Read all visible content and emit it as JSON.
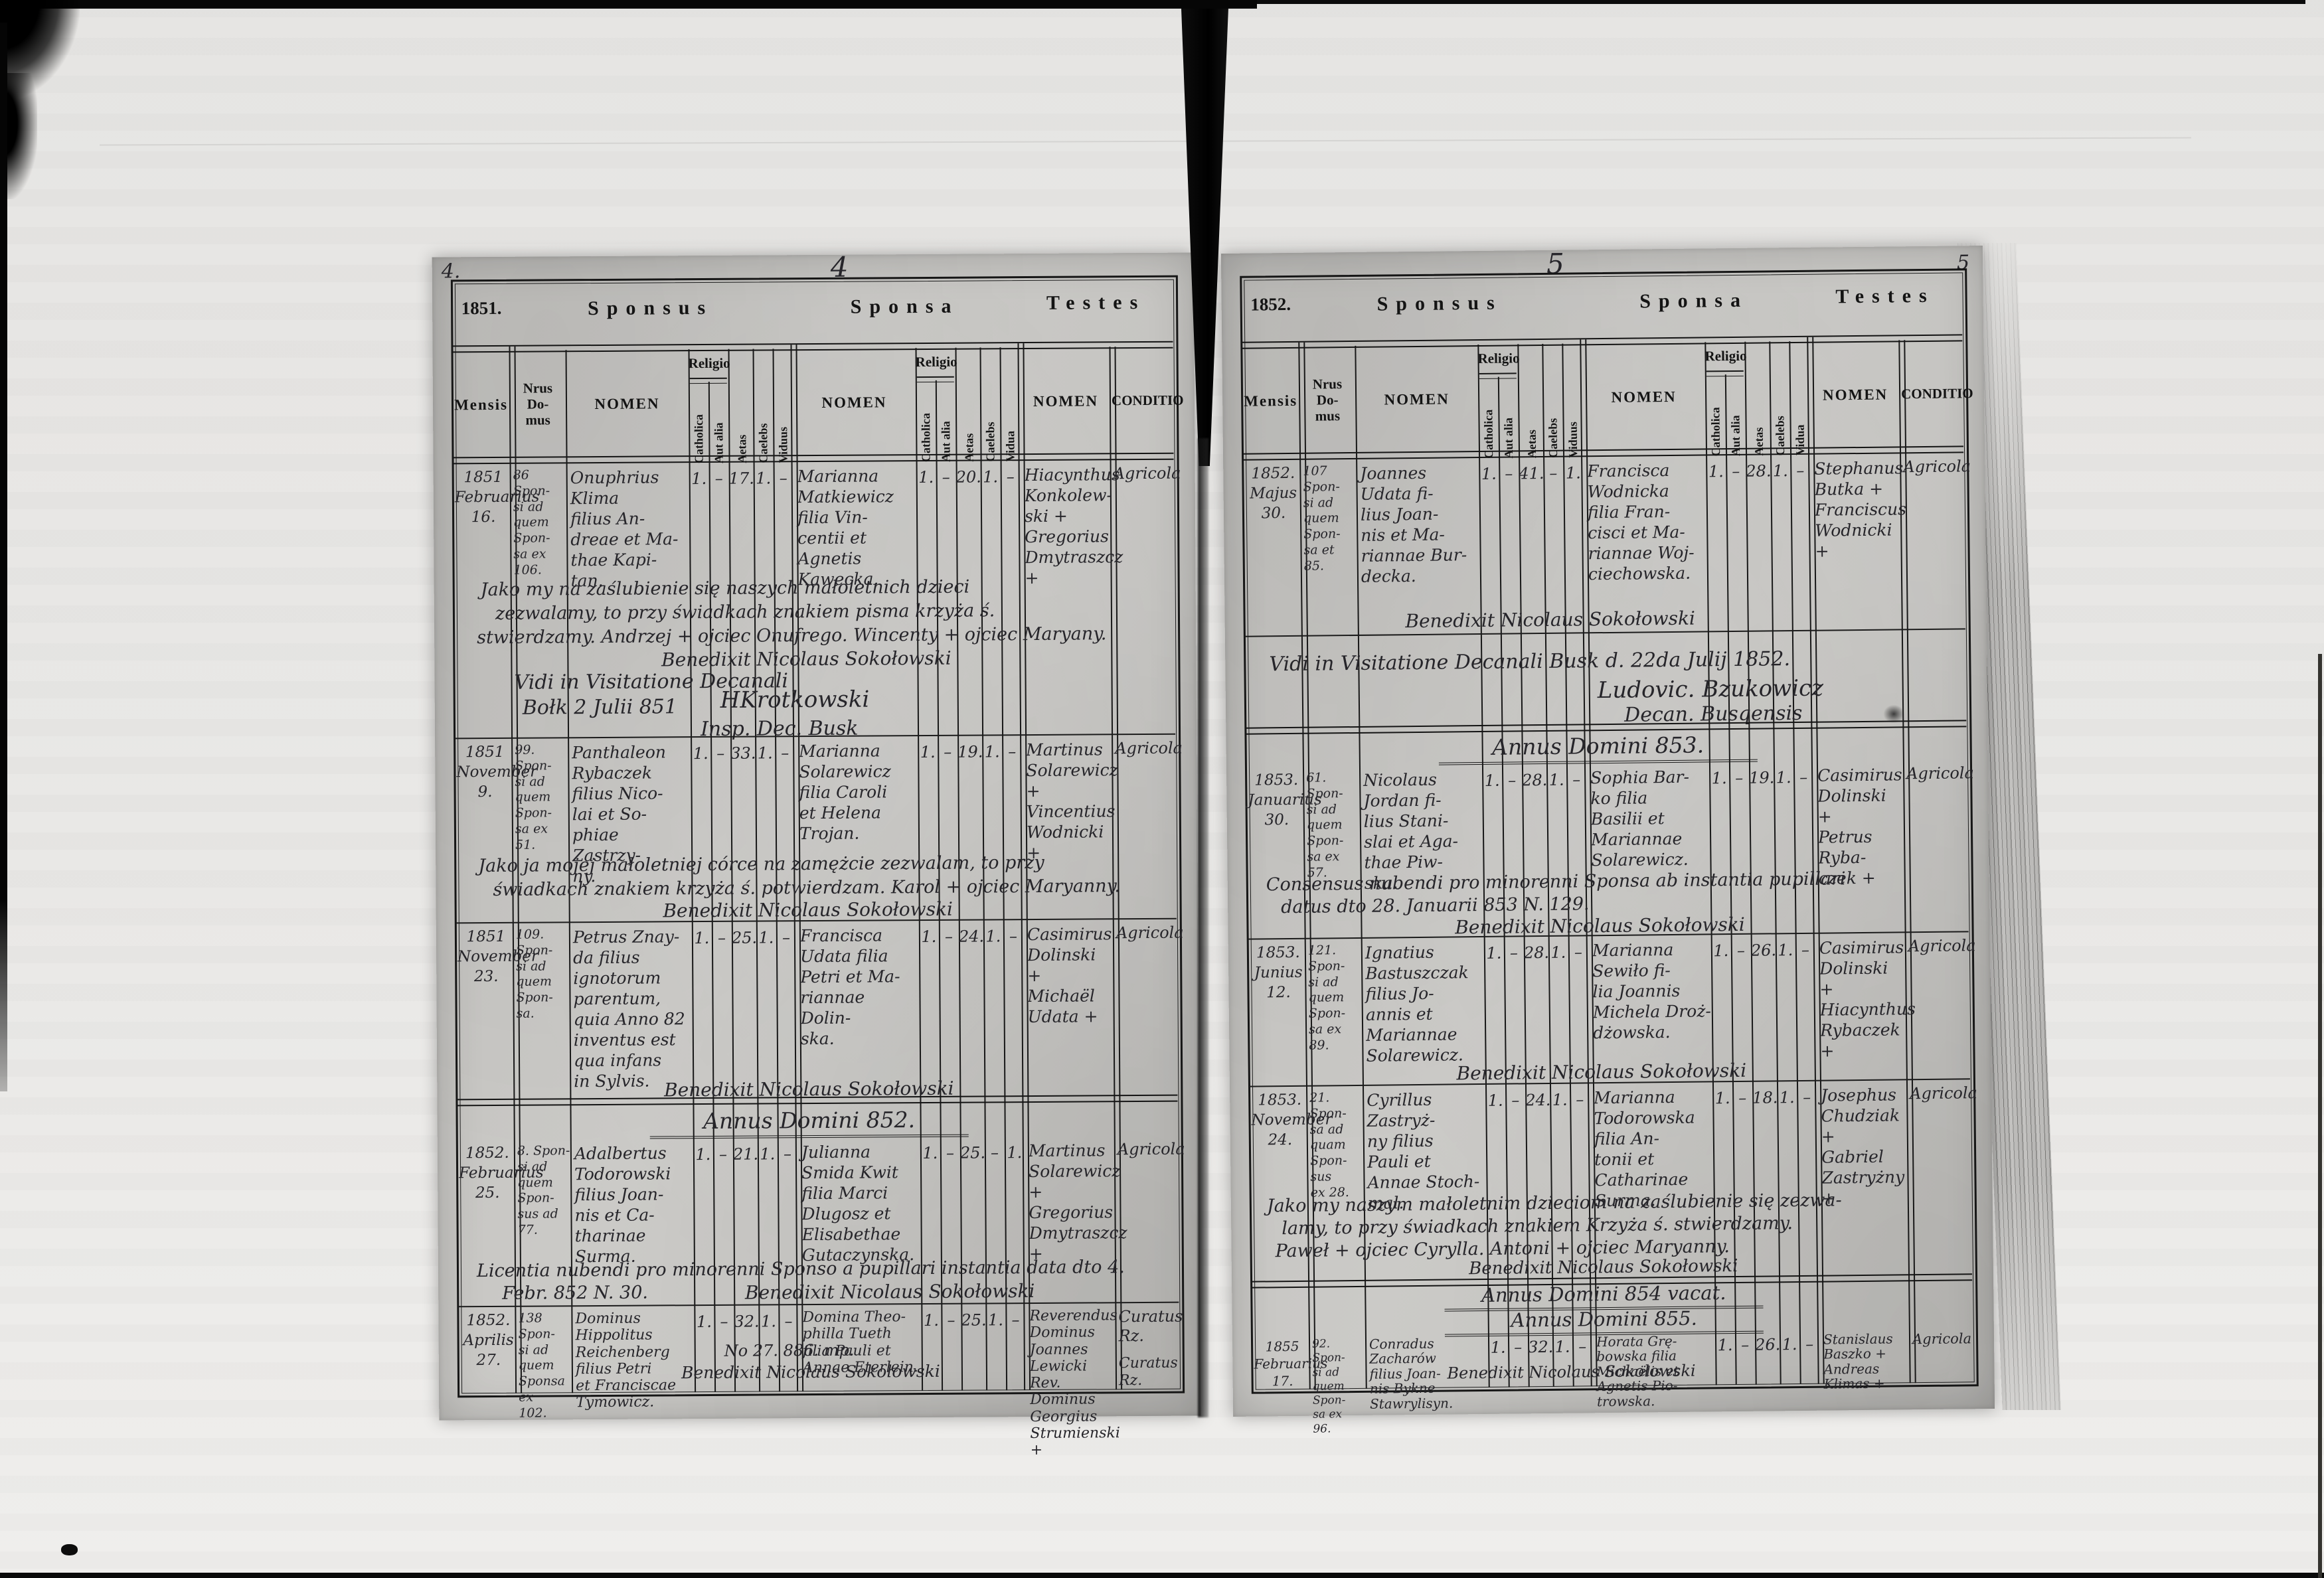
{
  "labels": {
    "sponsus": "Sponsus",
    "sponsa": "Sponsa",
    "testes": "Testes",
    "mensis": "Mensis",
    "nrus_domus": "Nrus\nDo-\nmus",
    "nomen": "NOMEN",
    "religio": "Religio",
    "catholica": "Catholica",
    "aut_alia": "Aut alia",
    "aetas": "Aetas",
    "caelebs": "Caelebs",
    "viduus": "Viduus",
    "vidua": "Vidua",
    "conditio": "CONDITIO"
  },
  "p4": {
    "corner": "4.",
    "number": "4",
    "year": "1851.",
    "heading_852": "Annus Domini 852.",
    "visitation": {
      "l1": "Vidi in Visitatione Decanali",
      "l2": "Bołk 2 Julii 851",
      "sig": "HKrotkowski",
      "l3": "Insp. Dec. Busk"
    },
    "e": [
      {
        "date": "1851\nFebruarius\n16.",
        "house": "86 Spon-\nsi ad\nquem\nSpon-\nsa ex\n106.",
        "sponsus": "Onuphrius\nKlima\nfilius An-\ndreae et Ma-\nthae Kapi-\ntan.",
        "sv": [
          "1.",
          "–",
          "17.",
          "1.",
          "–"
        ],
        "sponsa": "Marianna\nMatkiewicz\nfilia Vin-\ncentii et\nAgnetis\nKawecka.",
        "pv": [
          "1.",
          "–",
          "20.",
          "1.",
          "–"
        ],
        "testes": "Hiacynthus\nKonkolew-\nski +\nGregorius\nDmytraszcz +",
        "conditio": "Agricola",
        "note1": "Jako my na zaślubienie się naszych małoletnich dzieci",
        "note2": "zezwalamy, to przy świadkach znakiem pisma krzyża ś.",
        "note3": "stwierdzamy. Andrzej + ojciec Onufrego. Wincenty + ojciec Maryany.",
        "benedixit": "Benedixit Nicolaus Sokołowski"
      },
      {
        "date": "1851\nNovember\n9.",
        "house": "99. Spon-\nsi ad\nquem\nSpon-\nsa ex\n51.",
        "sponsus": "Panthaleon\nRybaczek\nfilius Nico-\nlai et So-\nphiae Zastrzy-\nny.",
        "sv": [
          "1.",
          "–",
          "33.",
          "1.",
          "–"
        ],
        "sponsa": "Marianna\nSolarewicz\nfilia Caroli\net Helena\nTrojan.",
        "pv": [
          "1.",
          "–",
          "19.",
          "1.",
          "–"
        ],
        "testes": "Martinus\nSolarewicz +\nVincentius\nWodnicki +",
        "conditio": "Agricola",
        "note1": "Jako ja mojej małoletniej córce na zamężcie zezwalam, to przy",
        "note2": "świadkach znakiem krzyża ś. potwierdzam. Karol + ojciec Maryanny.",
        "benedixit": "Benedixit Nicolaus Sokołowski"
      },
      {
        "date": "1851\nNovember\n23.",
        "house": "109.\nSpon-\nsi ad\nquem\nSpon-\nsa.",
        "sponsus": "Petrus Znay-\nda filius\nignotorum\nparentum,\nquia Anno 82\ninventus est\nqua infans\nin Sylvis.",
        "sv": [
          "1.",
          "–",
          "25.",
          "1.",
          "–"
        ],
        "sponsa": "Francisca\nUdata filia\nPetri et Ma-\nriannae Dolin-\nska.",
        "pv": [
          "1.",
          "–",
          "24.",
          "1.",
          "–"
        ],
        "testes": "Casimirus\nDolinski +\nMichaël\nUdata +",
        "conditio": "Agricola",
        "benedixit": "Benedixit Nicolaus Sokołowski"
      },
      {
        "date": "1852.\nFebruarius\n25.",
        "house": "8. Spon-\nsi ad\nquem\nSpon-\nsus ad\n77.",
        "sponsus": "Adalbertus\nTodorowski\nfilius Joan-\nnis et Ca-\ntharinae\nSurma.",
        "sv": [
          "1.",
          "–",
          "21.",
          "1.",
          "–"
        ],
        "sponsa": "Julianna\nSmida Kwit\nfilia Marci\nDlugosz et\nElisabethae\nGutaczynska.",
        "pv": [
          "1.",
          "–",
          "25.",
          "–",
          "1."
        ],
        "testes": "Martinus\nSolarewicz +\nGregorius\nDmytraszcz +",
        "conditio": "Agricola",
        "note1": "Licentia nubendi pro minorenni Sponso a pupillari instantia data dto 4.",
        "note2": "Febr. 852 N. 30.",
        "benedixit": "Benedixit Nicolaus Sokołowski"
      },
      {
        "date": "1852.\nAprilis\n27.",
        "house": "138 Spon-\nsi ad\nquem\nSponsa\nex\n102.",
        "sponsus": "Dominus\nHippolitus\nReichenberg\nfilius Petri\net Franciscae\nTymowicz.",
        "sv": [
          "1.",
          "–",
          "32.",
          "1.",
          "–"
        ],
        "sponsa": "Domina Theo-\nphilla Tueth\nfilia Pauli et\nAnnae Eterlein.",
        "pv": [
          "1.",
          "–",
          "25.",
          "1.",
          "–"
        ],
        "note_mid": "No 27. 886. mp.",
        "testes": "Reverendus\nDominus\nJoannes\nLewicki\nRev. Dominus\nGeorgius\nStrumienski +",
        "conditio": "Curatus Rz.",
        "conditio2": "Curatus\nRz.",
        "benedixit": "Benedixit Nicolaus Sokołowski"
      }
    ]
  },
  "p5": {
    "corner": "5",
    "number": "5",
    "year": "1852.",
    "heading_853": "Annus Domini 853.",
    "heading_854": "Annus Domini 854 vacat.",
    "heading_855": "Annus Domini 855.",
    "visitation": {
      "l1": "Vidi in Visitatione Decanali Busk d. 22da Julij 1852.",
      "l2": "Ludovic. Bzukowicz",
      "l3": "Decan. Busqensis"
    },
    "e": [
      {
        "date": "1852.\nMajus\n30.",
        "house": "107 Spon-\nsi ad\nquem\nSpon-\nsa et\n85.",
        "sponsus": "Joannes\nUdata fi-\nlius Joan-\nnis et Ma-\nriannae Bur-\ndecka.",
        "sv": [
          "1.",
          "–",
          "41.",
          "–",
          "1."
        ],
        "sponsa": "Francisca\nWodnicka\nfilia Fran-\ncisci et Ma-\nriannae Woj-\nciechowska.",
        "pv": [
          "1.",
          "–",
          "28.",
          "1.",
          "–"
        ],
        "testes": "Stephanus\nButka +\nFranciscus\nWodnicki +",
        "conditio": "Agricola",
        "benedixit": "Benedixit Nicolaus Sokołowski"
      },
      {
        "date": "1853.\nJanuarius\n30.",
        "house": "61. Spon-\nsi ad\nquem\nSpon-\nsa ex\n57.",
        "sponsus": "Nicolaus\nJordan fi-\nlius Stani-\nslai et Aga-\nthae Piw-\nska.",
        "sv": [
          "1.",
          "–",
          "28.",
          "1.",
          "–"
        ],
        "sponsa": "Sophia Bar-\nko filia\nBasilii et\nMariannae\nSolarewicz.",
        "pv": [
          "1.",
          "–",
          "19.",
          "1.",
          "–"
        ],
        "testes": "Casimirus\nDolinski +\nPetrus Ryba-\nczek +",
        "conditio": "Agricola",
        "note1": "Consensus nubendi pro minorenni Sponsa ab instantia pupillari",
        "note2": "datus dto 28. Januarii 853 N. 129.",
        "benedixit": "Benedixit Nicolaus Sokołowski"
      },
      {
        "date": "1853.\nJunius\n12.",
        "house": "121. Spon-\nsi ad\nquem\nSpon-\nsa ex\n89.",
        "sponsus": "Ignatius\nBastuszczak\nfilius Jo-\nannis et\nMariannae\nSolarewicz.",
        "sv": [
          "1.",
          "–",
          "28.",
          "1.",
          "–"
        ],
        "sponsa": "Marianna\nSewiło fi-\nlia Joannis\nMichela Droż-\ndżowska.",
        "pv": [
          "1.",
          "–",
          "26.",
          "1.",
          "–"
        ],
        "testes": "Casimirus\nDolinski +\nHiacynthus\nRybaczek +",
        "conditio": "Agricola",
        "benedixit": "Benedixit Nicolaus Sokołowski"
      },
      {
        "date": "1853.\nNovember\n24.",
        "house": "21. Spon-\nsa ad\nquam\nSpon-\nsus\nex 28.",
        "sponsus": "Cyrillus\nZastryż-\nny filius\nPauli et\nAnnae Stoch-\nmal.",
        "sv": [
          "1.",
          "–",
          "24.",
          "1.",
          "–"
        ],
        "sponsa": "Marianna\nTodorowska\nfilia An-\ntonii et\nCatharinae\nSurma.",
        "pv": [
          "1.",
          "–",
          "18.",
          "1.",
          "–"
        ],
        "testes": "Josephus\nChudziak +\nGabriel\nZastryżny +",
        "conditio": "Agricola",
        "note1": "Jako my naszym małoletnim dzieciom na zaślubienie się zezwa-",
        "note2": "lamy, to przy świadkach znakiem Krzyża ś. stwierdzamy.",
        "note3": "Paweł + ojciec Cyrylla. Antoni + ojciec Maryanny.",
        "benedixit": "Benedixit Nicolaus Sokołowski"
      },
      {
        "date": "1855\nFebruarius\n17.",
        "house": "92. Spon-\nsi ad\nquem\nSpon-\nsa ex\n96.",
        "sponsus": "Conradus\nZacharów\nfilius Joan-\nnis Bykne\nStawrylisyn.",
        "sv": [
          "1.",
          "–",
          "32.",
          "1.",
          "–"
        ],
        "sponsa": "Horata Grę-\nbowska filia\nMichaëlis et\nAgnetis Pio-\ntrowska.",
        "pv": [
          "1.",
          "–",
          "26.",
          "1.",
          "–"
        ],
        "testes": "Stanislaus\nBaszko +\nAndreas\nKlimas +",
        "conditio": "Agricola",
        "benedixit": "Benedixit Nicolaus Sokołowski"
      }
    ]
  }
}
